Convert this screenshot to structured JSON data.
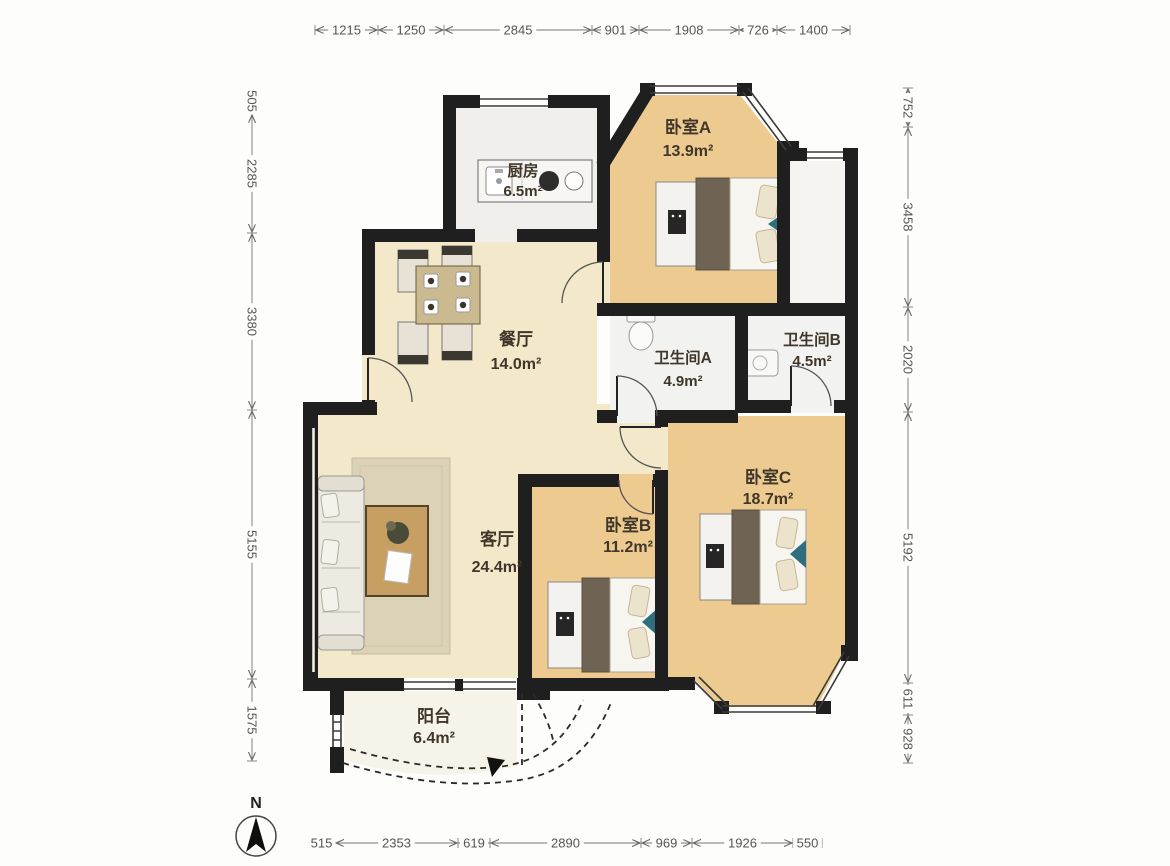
{
  "rooms": {
    "bedroom_a": {
      "name": "卧室A",
      "area": "13.9m²"
    },
    "bedroom_b": {
      "name": "卧室B",
      "area": "11.2m²"
    },
    "bedroom_c": {
      "name": "卧室C",
      "area": "18.7m²"
    },
    "kitchen": {
      "name": "厨房",
      "area": "6.5m²"
    },
    "dining": {
      "name": "餐厅",
      "area": "14.0m²"
    },
    "living": {
      "name": "客厅",
      "area": "24.4m²"
    },
    "bath_a": {
      "name": "卫生间A",
      "area": "4.9m²"
    },
    "bath_b": {
      "name": "卫生间B",
      "area": "4.5m²"
    },
    "balcony": {
      "name": "阳台",
      "area": "6.4m²"
    }
  },
  "dimensions": {
    "top": [
      "1215",
      "1250",
      "2845",
      "901",
      "1908",
      "726",
      "1400"
    ],
    "left": [
      "505",
      "2285",
      "3380",
      "5155",
      "1575"
    ],
    "right": [
      "752",
      "3458",
      "2020",
      "5192",
      "611",
      "928"
    ],
    "bottom": [
      "515",
      "2353",
      "619",
      "2890",
      "969",
      "1926",
      "550"
    ]
  },
  "compass": {
    "north_label": "N"
  },
  "colors": {
    "wall": "#1f1f1f",
    "bedroom_floor": "#ecca90",
    "living_floor": "#f3e9ca",
    "kitchen_floor": "#f0efeb",
    "bath_floor": "#f2f2f0",
    "balcony_floor": "#f6f3e9",
    "accent_teal": "#2f6f7d",
    "dim_text": "#555555",
    "label_text": "#40372a"
  }
}
